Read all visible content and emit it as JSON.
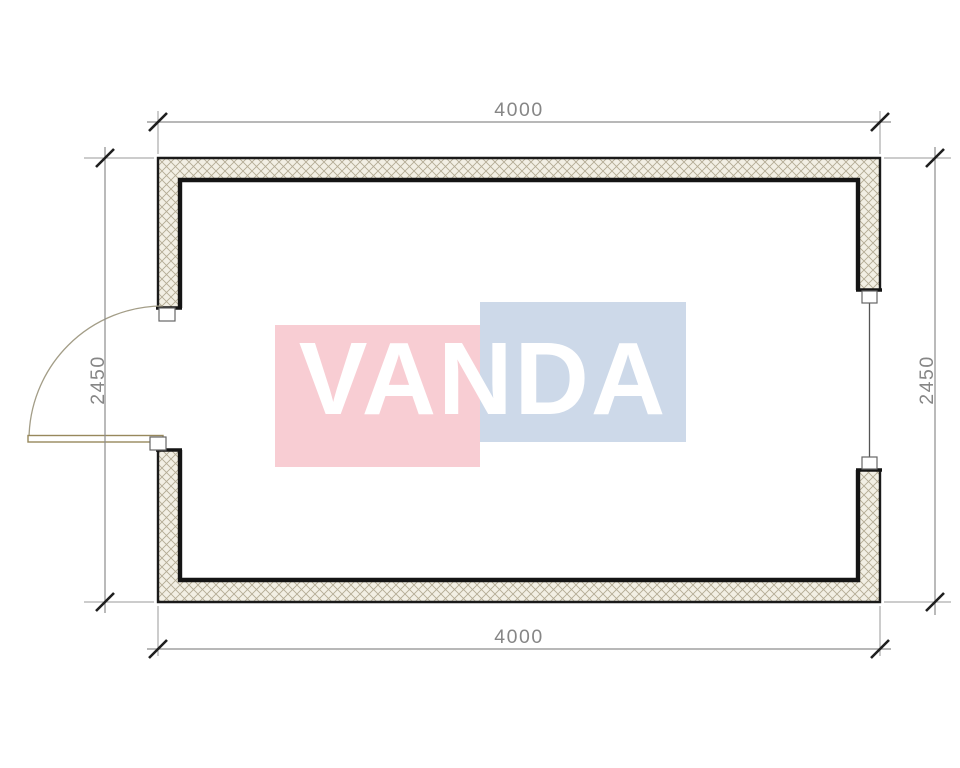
{
  "plan": {
    "type": "floor-plan",
    "dimension_labels": {
      "top": "4000",
      "bottom": "4000",
      "left": "2450",
      "right": "2450"
    },
    "watermark": {
      "text": "VANDA",
      "pink_color": "#f8cdd3",
      "blue_color": "#cdd9e9",
      "text_color": "#ffffff"
    },
    "colors": {
      "wall_outline": "#1a1a1a",
      "wall_inner_bold": "#141414",
      "hatch_line": "#b3ab94",
      "hatch_background": "#f2efe4",
      "dimension_line": "#8d8d8d",
      "extension_line": "#9a9a9a",
      "dimension_text": "#868686",
      "tick": "#1f1f1f",
      "door_leaf": "#97885c",
      "door_arc": "#a39d87",
      "window_line": "#555555",
      "jamb_outline": "#666666"
    },
    "features": {
      "door": "left-side swing door, opening outward",
      "window": "right-side window"
    }
  }
}
